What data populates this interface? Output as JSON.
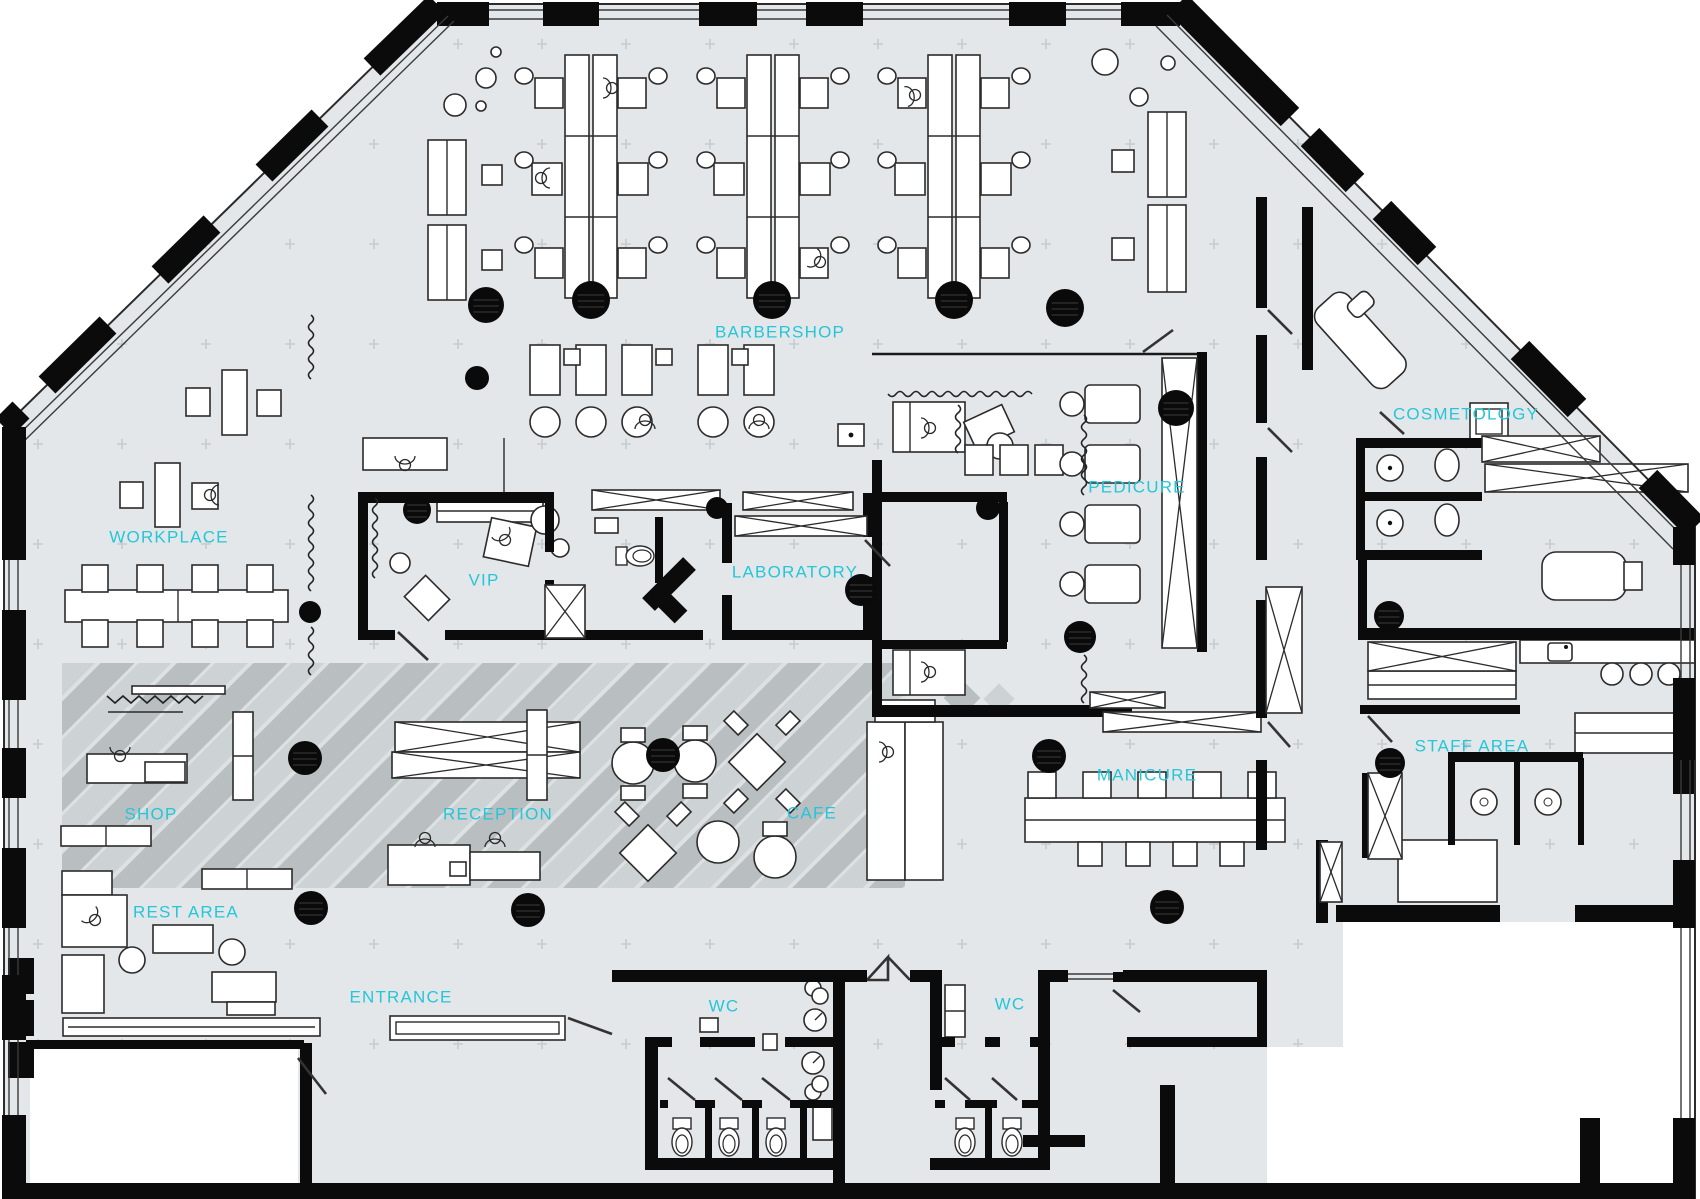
{
  "plan": {
    "canvas": {
      "width": 1700,
      "height": 1199
    },
    "colors": {
      "floor": "#e3e7ea",
      "outside": "#ffffff",
      "wall": "#0b0b0b",
      "label": "#25c6d8",
      "pattern_dark": "#b9bec1",
      "pattern_mid": "#cdd2d4",
      "grid_cross": "#c7cccf",
      "column": "#0a0a0a"
    },
    "rooms": [
      {
        "id": "barbershop",
        "label": "BARBERSHOP",
        "x": 780,
        "y": 332
      },
      {
        "id": "workplace",
        "label": "WORKPLACE",
        "x": 169,
        "y": 537
      },
      {
        "id": "vip",
        "label": "VIP",
        "x": 484,
        "y": 580
      },
      {
        "id": "laboratory",
        "label": "LABORATORY",
        "x": 795,
        "y": 572
      },
      {
        "id": "pedicure",
        "label": "PEDICURE",
        "x": 1137,
        "y": 487
      },
      {
        "id": "cosmetology",
        "label": "COSMETOLOGY",
        "x": 1466,
        "y": 414
      },
      {
        "id": "manicure",
        "label": "MANICURE",
        "x": 1147,
        "y": 775
      },
      {
        "id": "shop",
        "label": "SHOP",
        "x": 151,
        "y": 814
      },
      {
        "id": "reception",
        "label": "RECEPTION",
        "x": 498,
        "y": 814
      },
      {
        "id": "cafe",
        "label": "CAFE",
        "x": 812,
        "y": 813
      },
      {
        "id": "rest-area",
        "label": "REST AREA",
        "x": 186,
        "y": 912
      },
      {
        "id": "entrance",
        "label": "ENTRANCE",
        "x": 401,
        "y": 997
      },
      {
        "id": "wc-1",
        "label": "WC",
        "x": 724,
        "y": 1006
      },
      {
        "id": "wc-2",
        "label": "WC",
        "x": 1010,
        "y": 1004
      },
      {
        "id": "staff-area",
        "label": "STAFF AREA",
        "x": 1472,
        "y": 746
      }
    ],
    "columns": [
      {
        "x": 591,
        "y": 300,
        "r": 19
      },
      {
        "x": 772,
        "y": 300,
        "r": 19
      },
      {
        "x": 954,
        "y": 300,
        "r": 19
      },
      {
        "x": 1065,
        "y": 308,
        "r": 19
      },
      {
        "x": 486,
        "y": 305,
        "r": 18
      },
      {
        "x": 477,
        "y": 378,
        "r": 12
      },
      {
        "x": 417,
        "y": 510,
        "r": 14
      },
      {
        "x": 717,
        "y": 508,
        "r": 11
      },
      {
        "x": 988,
        "y": 508,
        "r": 12
      },
      {
        "x": 1176,
        "y": 408,
        "r": 18
      },
      {
        "x": 861,
        "y": 590,
        "r": 16
      },
      {
        "x": 310,
        "y": 612,
        "r": 11
      },
      {
        "x": 1080,
        "y": 637,
        "r": 16
      },
      {
        "x": 305,
        "y": 758,
        "r": 17
      },
      {
        "x": 663,
        "y": 755,
        "r": 17
      },
      {
        "x": 1049,
        "y": 756,
        "r": 17
      },
      {
        "x": 311,
        "y": 908,
        "r": 17
      },
      {
        "x": 528,
        "y": 910,
        "r": 17
      },
      {
        "x": 1167,
        "y": 907,
        "r": 17
      },
      {
        "x": 1389,
        "y": 616,
        "r": 15
      },
      {
        "x": 1390,
        "y": 763,
        "r": 15
      }
    ],
    "grid": {
      "x0": 38,
      "dx": 84,
      "nx": 20,
      "y0": 44,
      "dy": 100,
      "ny": 11
    }
  }
}
